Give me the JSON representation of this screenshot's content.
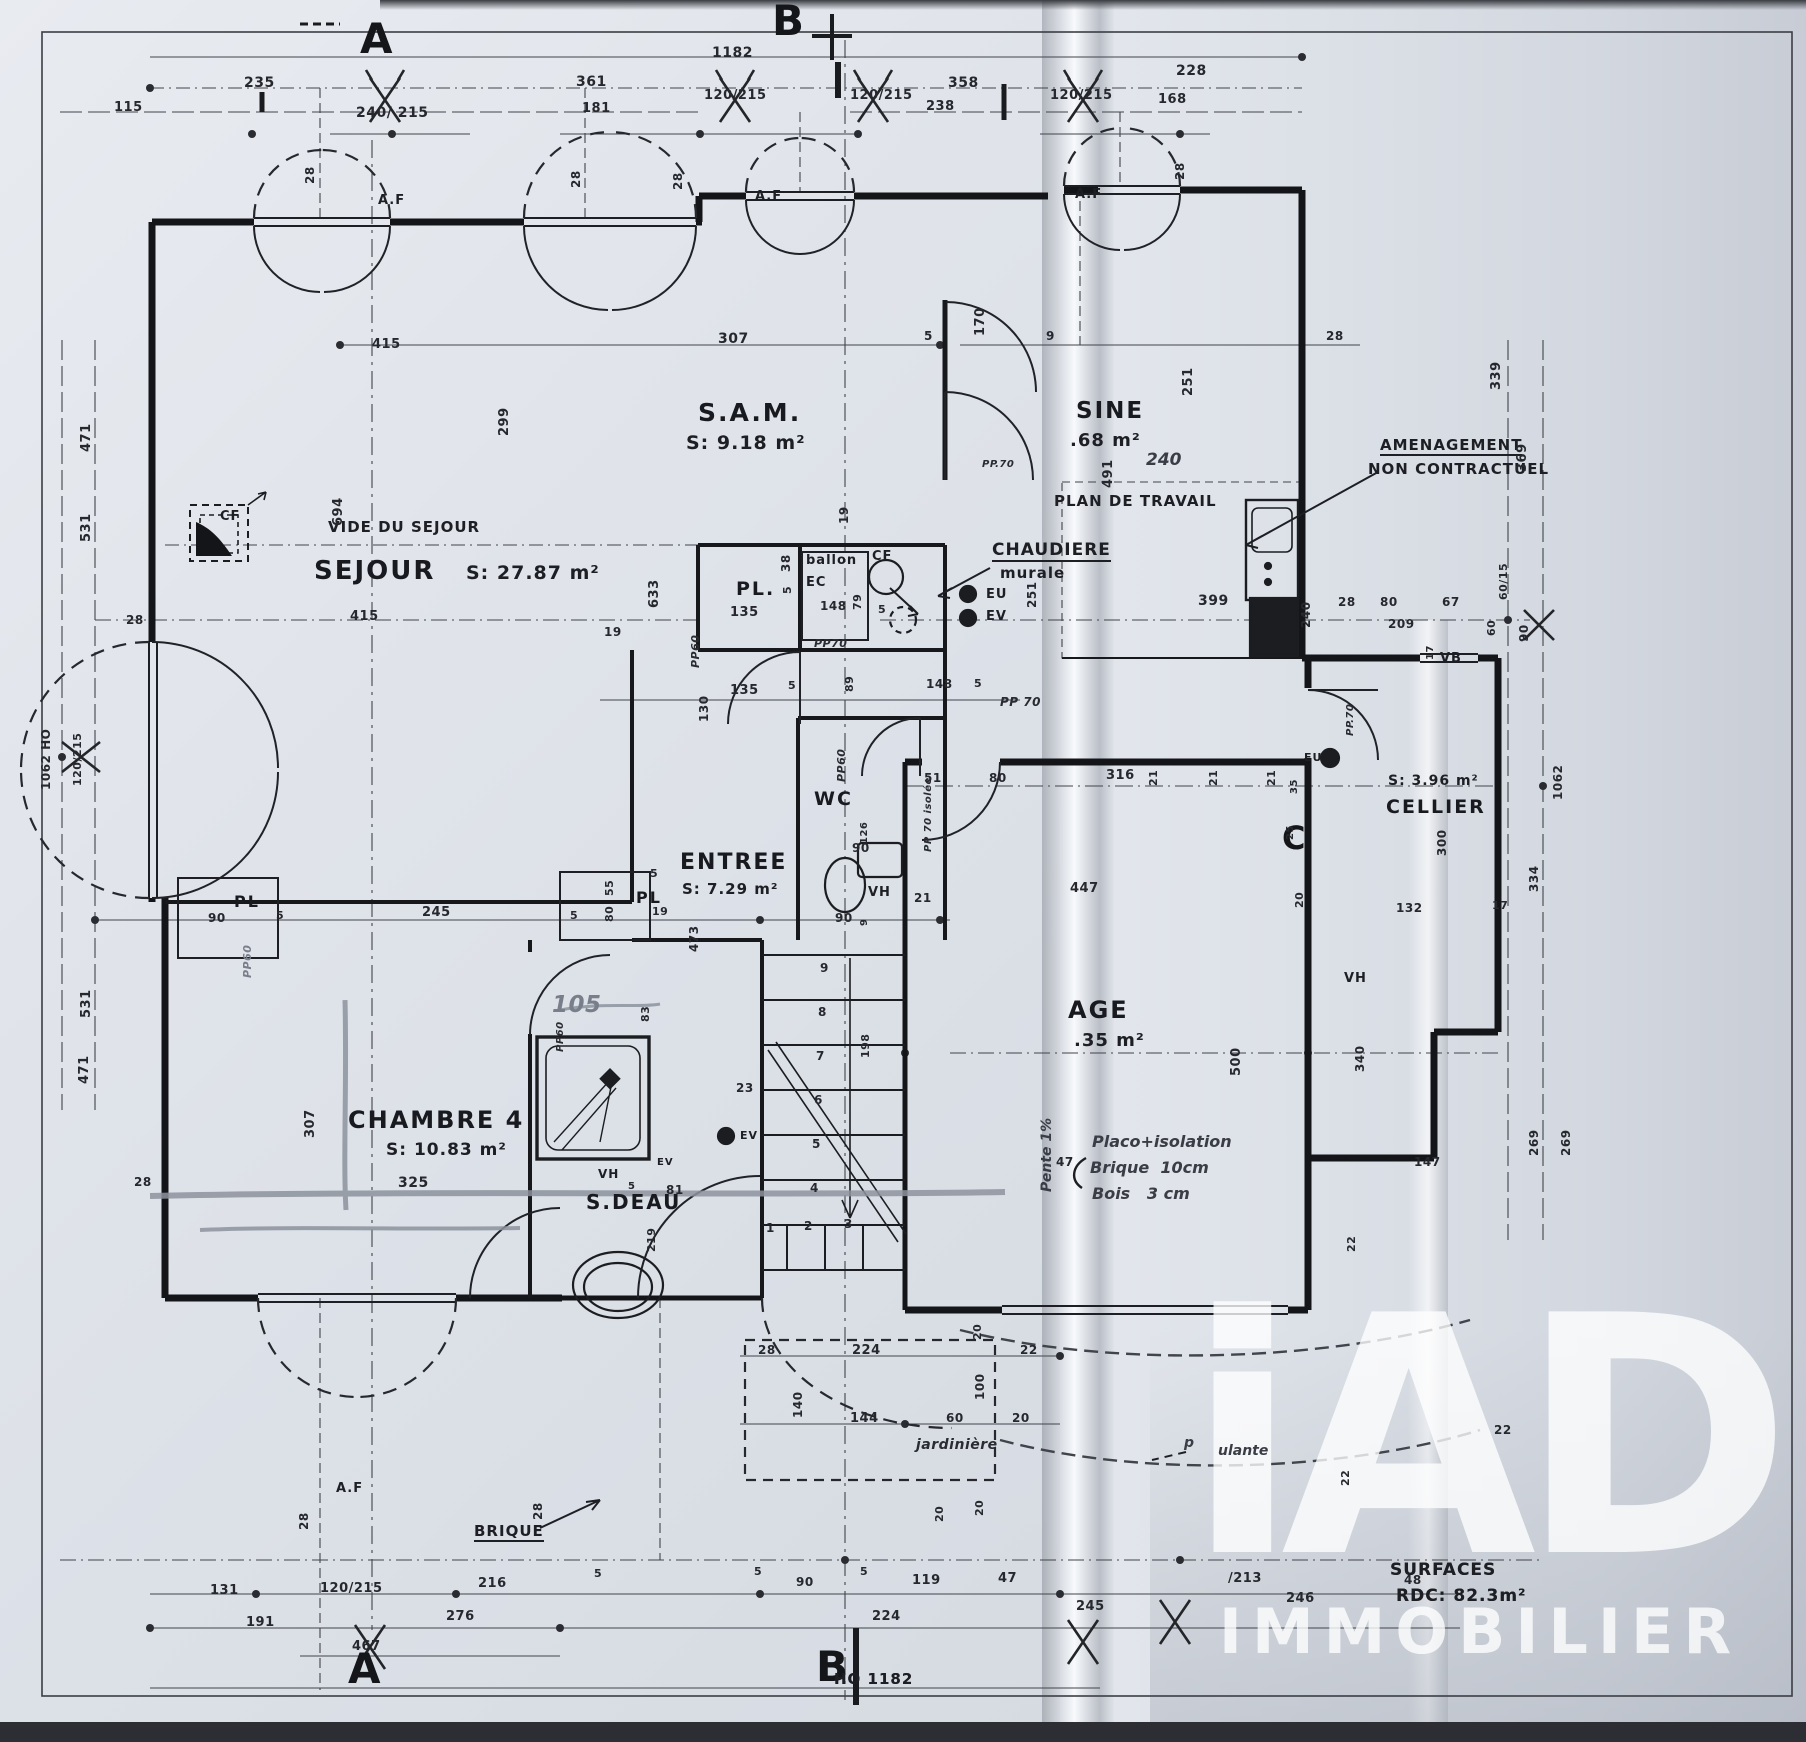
{
  "watermark": {
    "brand": "iAD",
    "subtitle": "IMMOBILIER"
  },
  "footer": {
    "surfaces_title": "SURFACES",
    "surfaces_value": "RDC: 82.3m²",
    "plan_ref": "HO 1182"
  },
  "section_markers": [
    {
      "t": "A",
      "x": 360,
      "y": 18,
      "s": 42
    },
    {
      "t": "B",
      "x": 772,
      "y": 0,
      "s": 42
    },
    {
      "t": "A",
      "x": 348,
      "y": 1648,
      "s": 42
    },
    {
      "t": "B",
      "x": 816,
      "y": 1646,
      "s": 42
    },
    {
      "t": "C",
      "x": 1282,
      "y": 822,
      "s": 32
    }
  ],
  "rooms": [
    {
      "t": "SEJOUR",
      "x": 314,
      "y": 558,
      "s": 26
    },
    {
      "t": "S: 27.87 m²",
      "x": 466,
      "y": 564,
      "s": 19,
      "k": "area"
    },
    {
      "t": "S.A.M.",
      "x": 698,
      "y": 400,
      "s": 25
    },
    {
      "t": "S: 9.18 m²",
      "x": 686,
      "y": 434,
      "s": 19,
      "k": "area"
    },
    {
      "t": "SINE",
      "x": 1076,
      "y": 400,
      "s": 23
    },
    {
      "t": ".68 m²",
      "x": 1070,
      "y": 432,
      "s": 18,
      "k": "area"
    },
    {
      "t": "ENTREE",
      "x": 680,
      "y": 852,
      "s": 22
    },
    {
      "t": "S: 7.29 m²",
      "x": 682,
      "y": 882,
      "s": 15,
      "k": "area"
    },
    {
      "t": "CHAMBRE 4",
      "x": 348,
      "y": 1108,
      "s": 24
    },
    {
      "t": "S: 10.83 m²",
      "x": 386,
      "y": 1142,
      "s": 17,
      "k": "area"
    },
    {
      "t": "S.DEAU",
      "x": 586,
      "y": 1192,
      "s": 20
    },
    {
      "t": "WC",
      "x": 814,
      "y": 790,
      "s": 19
    },
    {
      "t": "CELLIER",
      "x": 1386,
      "y": 798,
      "s": 19
    },
    {
      "t": "S: 3.96 m²",
      "x": 1388,
      "y": 774,
      "s": 14,
      "k": "area"
    },
    {
      "t": "AGE",
      "x": 1068,
      "y": 998,
      "s": 24
    },
    {
      "t": ".35 m²",
      "x": 1074,
      "y": 1032,
      "s": 18,
      "k": "area"
    },
    {
      "t": "PL.",
      "x": 736,
      "y": 580,
      "s": 19
    },
    {
      "t": "PL",
      "x": 234,
      "y": 894,
      "s": 16
    },
    {
      "t": "PL",
      "x": 636,
      "y": 890,
      "s": 16
    },
    {
      "t": "VIDE DU SEJOUR",
      "x": 328,
      "y": 520,
      "s": 15,
      "k": "ann"
    },
    {
      "t": "PLAN DE TRAVAIL",
      "x": 1054,
      "y": 494,
      "s": 15,
      "k": "ann"
    }
  ],
  "annotations": [
    {
      "t": "A.F",
      "x": 378,
      "y": 194,
      "s": 13
    },
    {
      "t": "A.F",
      "x": 755,
      "y": 190,
      "s": 13
    },
    {
      "t": "A.F",
      "x": 1075,
      "y": 188,
      "s": 13
    },
    {
      "t": "A.F",
      "x": 336,
      "y": 1482,
      "s": 13
    },
    {
      "t": "CF",
      "x": 220,
      "y": 510,
      "s": 13
    },
    {
      "t": "CF",
      "x": 872,
      "y": 550,
      "s": 13
    },
    {
      "t": "ballon",
      "x": 806,
      "y": 554,
      "s": 13
    },
    {
      "t": "EC",
      "x": 806,
      "y": 576,
      "s": 13
    },
    {
      "t": "CHAUDIERE",
      "x": 992,
      "y": 542,
      "s": 17,
      "u": true
    },
    {
      "t": "murale",
      "x": 1000,
      "y": 566,
      "s": 15
    },
    {
      "t": "EU",
      "x": 986,
      "y": 588,
      "s": 13
    },
    {
      "t": "EV",
      "x": 986,
      "y": 610,
      "s": 13
    },
    {
      "t": "AMENAGEMENT",
      "x": 1380,
      "y": 438,
      "s": 15,
      "u": true
    },
    {
      "t": "NON CONTRACTUEL",
      "x": 1368,
      "y": 462,
      "s": 15
    },
    {
      "t": "VB",
      "x": 1440,
      "y": 652,
      "s": 13
    },
    {
      "t": "EU",
      "x": 1304,
      "y": 752,
      "s": 11
    },
    {
      "t": "VH",
      "x": 868,
      "y": 886,
      "s": 13
    },
    {
      "t": "VH",
      "x": 1344,
      "y": 972,
      "s": 13
    },
    {
      "t": "VH",
      "x": 598,
      "y": 1168,
      "s": 12
    },
    {
      "t": "EV",
      "x": 740,
      "y": 1130,
      "s": 11
    },
    {
      "t": "EV",
      "x": 657,
      "y": 1158,
      "s": 10
    },
    {
      "t": "jardinière",
      "x": 916,
      "y": 1438,
      "s": 14,
      "k": "it"
    },
    {
      "t": "BRIQUE",
      "x": 474,
      "y": 1524,
      "s": 15,
      "u": true
    },
    {
      "t": "PP60",
      "x": 690,
      "y": 668,
      "s": 11,
      "r": 1,
      "k": "it"
    },
    {
      "t": "PP60",
      "x": 836,
      "y": 782,
      "s": 11,
      "r": 1,
      "k": "it"
    },
    {
      "t": "PP60",
      "x": 242,
      "y": 978,
      "s": 11,
      "r": 1,
      "k": "pencil"
    },
    {
      "t": "PP60",
      "x": 556,
      "y": 1052,
      "s": 10,
      "r": 1,
      "k": "it"
    },
    {
      "t": "PP.70",
      "x": 982,
      "y": 460,
      "s": 10,
      "k": "it"
    },
    {
      "t": "PP70",
      "x": 814,
      "y": 638,
      "s": 11,
      "k": "it"
    },
    {
      "t": "PP 70",
      "x": 1000,
      "y": 696,
      "s": 12,
      "k": "it"
    },
    {
      "t": "PP 70 isolée",
      "x": 924,
      "y": 852,
      "s": 10,
      "r": 1,
      "k": "it"
    },
    {
      "t": "PP.70",
      "x": 1346,
      "y": 736,
      "s": 10,
      "r": 1,
      "k": "it"
    },
    {
      "t": "SURFACES",
      "x": 1390,
      "y": 1562,
      "s": 17
    },
    {
      "t": "RDC: 82.3m²",
      "x": 1396,
      "y": 1588,
      "s": 17
    },
    {
      "t": "HO 1182",
      "x": 834,
      "y": 1672,
      "s": 15
    }
  ],
  "handwritten": [
    {
      "t": "240",
      "x": 1146,
      "y": 452,
      "s": 17
    },
    {
      "t": "105",
      "x": 552,
      "y": 994,
      "s": 23,
      "k": "pencil"
    },
    {
      "t": "Placo+isolation",
      "x": 1092,
      "y": 1134,
      "s": 16
    },
    {
      "t": "Brique  10cm",
      "x": 1090,
      "y": 1160,
      "s": 16
    },
    {
      "t": "Bois   3 cm",
      "x": 1092,
      "y": 1186,
      "s": 16
    },
    {
      "t": "Pente 1%",
      "x": 1040,
      "y": 1192,
      "s": 14,
      "r": 1
    },
    {
      "t": "p",
      "x": 1184,
      "y": 1436,
      "s": 14
    },
    {
      "t": "ulante",
      "x": 1218,
      "y": 1444,
      "s": 14
    }
  ],
  "dimensions": [
    {
      "t": "1182",
      "x": 712,
      "y": 46,
      "s": 14
    },
    {
      "t": "235",
      "x": 244,
      "y": 76,
      "s": 14
    },
    {
      "t": "115",
      "x": 114,
      "y": 101,
      "s": 13
    },
    {
      "t": "240/ 215",
      "x": 356,
      "y": 106,
      "s": 14
    },
    {
      "t": "361",
      "x": 576,
      "y": 75,
      "s": 14
    },
    {
      "t": "181",
      "x": 582,
      "y": 102,
      "s": 13
    },
    {
      "t": "120/215",
      "x": 704,
      "y": 89,
      "s": 13
    },
    {
      "t": "120/215",
      "x": 850,
      "y": 89,
      "s": 13
    },
    {
      "t": "358",
      "x": 948,
      "y": 76,
      "s": 14
    },
    {
      "t": "238",
      "x": 926,
      "y": 100,
      "s": 13
    },
    {
      "t": "120/215",
      "x": 1050,
      "y": 89,
      "s": 13
    },
    {
      "t": "228",
      "x": 1176,
      "y": 64,
      "s": 14
    },
    {
      "t": "168",
      "x": 1158,
      "y": 93,
      "s": 13
    },
    {
      "t": "28",
      "x": 304,
      "y": 184,
      "s": 12,
      "r": 1
    },
    {
      "t": "28",
      "x": 570,
      "y": 188,
      "s": 12,
      "r": 1
    },
    {
      "t": "28",
      "x": 672,
      "y": 190,
      "s": 12,
      "r": 1
    },
    {
      "t": "28",
      "x": 1174,
      "y": 180,
      "s": 12,
      "r": 1
    },
    {
      "t": "471",
      "x": 80,
      "y": 452,
      "s": 13,
      "r": 1
    },
    {
      "t": "531",
      "x": 80,
      "y": 542,
      "s": 13,
      "r": 1
    },
    {
      "t": "1062 HO",
      "x": 40,
      "y": 790,
      "s": 12,
      "r": 1
    },
    {
      "t": "120/215",
      "x": 72,
      "y": 786,
      "s": 11,
      "r": 1
    },
    {
      "t": "28",
      "x": 126,
      "y": 614,
      "s": 12
    },
    {
      "t": "531",
      "x": 80,
      "y": 1018,
      "s": 13,
      "r": 1
    },
    {
      "t": "471",
      "x": 78,
      "y": 1084,
      "s": 13,
      "r": 1
    },
    {
      "t": "28",
      "x": 134,
      "y": 1176,
      "s": 12
    },
    {
      "t": "415",
      "x": 372,
      "y": 338,
      "s": 13
    },
    {
      "t": "307",
      "x": 718,
      "y": 332,
      "s": 14
    },
    {
      "t": "5",
      "x": 924,
      "y": 330,
      "s": 12
    },
    {
      "t": "9",
      "x": 1046,
      "y": 330,
      "s": 12
    },
    {
      "t": "170",
      "x": 974,
      "y": 336,
      "s": 13,
      "r": 1
    },
    {
      "t": "299",
      "x": 498,
      "y": 436,
      "s": 13,
      "r": 1
    },
    {
      "t": "251",
      "x": 1182,
      "y": 396,
      "s": 13,
      "r": 1
    },
    {
      "t": "491",
      "x": 1102,
      "y": 488,
      "s": 13,
      "r": 1
    },
    {
      "t": "28",
      "x": 1326,
      "y": 330,
      "s": 12
    },
    {
      "t": "339",
      "x": 1490,
      "y": 390,
      "s": 13,
      "r": 1
    },
    {
      "t": "369",
      "x": 1516,
      "y": 472,
      "s": 13,
      "r": 1
    },
    {
      "t": "694",
      "x": 332,
      "y": 526,
      "s": 13,
      "r": 1
    },
    {
      "t": "415",
      "x": 350,
      "y": 610,
      "s": 13
    },
    {
      "t": "633",
      "x": 648,
      "y": 608,
      "s": 13,
      "r": 1
    },
    {
      "t": "19",
      "x": 838,
      "y": 524,
      "s": 12,
      "r": 1
    },
    {
      "t": "38",
      "x": 780,
      "y": 572,
      "s": 12,
      "r": 1
    },
    {
      "t": "5",
      "x": 782,
      "y": 594,
      "s": 11,
      "r": 1
    },
    {
      "t": "135",
      "x": 730,
      "y": 606,
      "s": 13
    },
    {
      "t": "148",
      "x": 820,
      "y": 600,
      "s": 12
    },
    {
      "t": "79",
      "x": 852,
      "y": 610,
      "s": 11,
      "r": 1
    },
    {
      "t": "5",
      "x": 878,
      "y": 604,
      "s": 11
    },
    {
      "t": "399",
      "x": 1198,
      "y": 594,
      "s": 14
    },
    {
      "t": "251",
      "x": 1026,
      "y": 608,
      "s": 12,
      "r": 1
    },
    {
      "t": "28",
      "x": 1338,
      "y": 596,
      "s": 12
    },
    {
      "t": "80",
      "x": 1380,
      "y": 596,
      "s": 12
    },
    {
      "t": "67",
      "x": 1442,
      "y": 596,
      "s": 12
    },
    {
      "t": "209",
      "x": 1388,
      "y": 618,
      "s": 12
    },
    {
      "t": "240",
      "x": 1300,
      "y": 628,
      "s": 12,
      "r": 1
    },
    {
      "t": "60/15",
      "x": 1498,
      "y": 600,
      "s": 11,
      "r": 1
    },
    {
      "t": "60",
      "x": 1486,
      "y": 636,
      "s": 11,
      "r": 1
    },
    {
      "t": "90",
      "x": 1518,
      "y": 642,
      "s": 12,
      "r": 1
    },
    {
      "t": "17",
      "x": 1426,
      "y": 660,
      "s": 10,
      "r": 1
    },
    {
      "t": "19",
      "x": 604,
      "y": 626,
      "s": 12
    },
    {
      "t": "135",
      "x": 730,
      "y": 684,
      "s": 13
    },
    {
      "t": "5",
      "x": 788,
      "y": 680,
      "s": 11
    },
    {
      "t": "89",
      "x": 844,
      "y": 692,
      "s": 11,
      "r": 1
    },
    {
      "t": "148",
      "x": 926,
      "y": 678,
      "s": 12
    },
    {
      "t": "5",
      "x": 974,
      "y": 678,
      "s": 11
    },
    {
      "t": "130",
      "x": 698,
      "y": 722,
      "s": 12,
      "r": 1
    },
    {
      "t": "51",
      "x": 924,
      "y": 772,
      "s": 12
    },
    {
      "t": "80",
      "x": 989,
      "y": 772,
      "s": 12
    },
    {
      "t": "316",
      "x": 1106,
      "y": 769,
      "s": 13
    },
    {
      "t": "21",
      "x": 1148,
      "y": 786,
      "s": 11,
      "r": 1
    },
    {
      "t": "21",
      "x": 1208,
      "y": 786,
      "s": 11,
      "r": 1
    },
    {
      "t": "21",
      "x": 1266,
      "y": 786,
      "s": 11,
      "r": 1
    },
    {
      "t": "35",
      "x": 1290,
      "y": 794,
      "s": 10,
      "r": 1
    },
    {
      "t": "25",
      "x": 1286,
      "y": 840,
      "s": 10,
      "r": 1
    },
    {
      "t": "126",
      "x": 860,
      "y": 844,
      "s": 10,
      "r": 1
    },
    {
      "t": "90",
      "x": 852,
      "y": 842,
      "s": 12
    },
    {
      "t": "21",
      "x": 914,
      "y": 892,
      "s": 12
    },
    {
      "t": "90",
      "x": 835,
      "y": 912,
      "s": 12
    },
    {
      "t": "9",
      "x": 860,
      "y": 926,
      "s": 10,
      "r": 1
    },
    {
      "t": "447",
      "x": 1070,
      "y": 882,
      "s": 13
    },
    {
      "t": "473",
      "x": 688,
      "y": 952,
      "s": 12,
      "r": 1
    },
    {
      "t": "500",
      "x": 1230,
      "y": 1076,
      "s": 13,
      "r": 1
    },
    {
      "t": "340",
      "x": 1354,
      "y": 1072,
      "s": 12,
      "r": 1
    },
    {
      "t": "132",
      "x": 1396,
      "y": 902,
      "s": 12
    },
    {
      "t": "17",
      "x": 1492,
      "y": 900,
      "s": 11
    },
    {
      "t": "20",
      "x": 1294,
      "y": 908,
      "s": 11,
      "r": 1
    },
    {
      "t": "300",
      "x": 1436,
      "y": 856,
      "s": 12,
      "r": 1
    },
    {
      "t": "334",
      "x": 1528,
      "y": 892,
      "s": 12,
      "r": 1
    },
    {
      "t": "1062",
      "x": 1552,
      "y": 800,
      "s": 12,
      "r": 1
    },
    {
      "t": "147",
      "x": 1414,
      "y": 1156,
      "s": 12
    },
    {
      "t": "269",
      "x": 1528,
      "y": 1156,
      "s": 12,
      "r": 1
    },
    {
      "t": "269",
      "x": 1560,
      "y": 1156,
      "s": 12,
      "r": 1
    },
    {
      "t": "22",
      "x": 1346,
      "y": 1252,
      "s": 11,
      "r": 1
    },
    {
      "t": "90",
      "x": 208,
      "y": 912,
      "s": 12
    },
    {
      "t": "5",
      "x": 276,
      "y": 910,
      "s": 11
    },
    {
      "t": "245",
      "x": 422,
      "y": 906,
      "s": 13
    },
    {
      "t": "5",
      "x": 570,
      "y": 910,
      "s": 11
    },
    {
      "t": "80",
      "x": 604,
      "y": 922,
      "s": 11,
      "r": 1
    },
    {
      "t": "55",
      "x": 604,
      "y": 896,
      "s": 11,
      "r": 1
    },
    {
      "t": "5",
      "x": 650,
      "y": 868,
      "s": 11
    },
    {
      "t": "19",
      "x": 652,
      "y": 906,
      "s": 11
    },
    {
      "t": "307",
      "x": 304,
      "y": 1138,
      "s": 13,
      "r": 1
    },
    {
      "t": "325",
      "x": 398,
      "y": 1176,
      "s": 14
    },
    {
      "t": "83",
      "x": 640,
      "y": 1022,
      "s": 11,
      "r": 1
    },
    {
      "t": "23",
      "x": 736,
      "y": 1082,
      "s": 12
    },
    {
      "t": "81",
      "x": 666,
      "y": 1184,
      "s": 12
    },
    {
      "t": "5",
      "x": 628,
      "y": 1182,
      "s": 10
    },
    {
      "t": "219",
      "x": 646,
      "y": 1252,
      "s": 11,
      "r": 1
    },
    {
      "t": "198",
      "x": 860,
      "y": 1058,
      "s": 11,
      "r": 1
    },
    {
      "t": "9",
      "x": 820,
      "y": 962,
      "s": 12
    },
    {
      "t": "8",
      "x": 818,
      "y": 1006,
      "s": 12
    },
    {
      "t": "7",
      "x": 816,
      "y": 1050,
      "s": 12
    },
    {
      "t": "6",
      "x": 814,
      "y": 1094,
      "s": 12
    },
    {
      "t": "5",
      "x": 812,
      "y": 1138,
      "s": 12
    },
    {
      "t": "4",
      "x": 810,
      "y": 1182,
      "s": 12
    },
    {
      "t": "1",
      "x": 766,
      "y": 1222,
      "s": 12
    },
    {
      "t": "2",
      "x": 804,
      "y": 1220,
      "s": 12
    },
    {
      "t": "3",
      "x": 844,
      "y": 1218,
      "s": 12
    },
    {
      "t": "28",
      "x": 758,
      "y": 1344,
      "s": 12
    },
    {
      "t": "224",
      "x": 852,
      "y": 1344,
      "s": 13
    },
    {
      "t": "22",
      "x": 1020,
      "y": 1344,
      "s": 12
    },
    {
      "t": "140",
      "x": 792,
      "y": 1418,
      "s": 12,
      "r": 1
    },
    {
      "t": "144",
      "x": 850,
      "y": 1412,
      "s": 13
    },
    {
      "t": "60",
      "x": 946,
      "y": 1412,
      "s": 12
    },
    {
      "t": "100",
      "x": 974,
      "y": 1400,
      "s": 12,
      "r": 1
    },
    {
      "t": "20",
      "x": 1012,
      "y": 1412,
      "s": 12
    },
    {
      "t": "20",
      "x": 972,
      "y": 1340,
      "s": 11,
      "r": 1
    },
    {
      "t": "20",
      "x": 974,
      "y": 1516,
      "s": 11,
      "r": 1
    },
    {
      "t": "47",
      "x": 1056,
      "y": 1156,
      "s": 12
    },
    {
      "t": "22",
      "x": 1494,
      "y": 1424,
      "s": 12
    },
    {
      "t": "22",
      "x": 1340,
      "y": 1486,
      "s": 11,
      "r": 1
    },
    {
      "t": "48",
      "x": 1404,
      "y": 1574,
      "s": 12
    },
    {
      "t": "246",
      "x": 1286,
      "y": 1592,
      "s": 13
    },
    {
      "t": "/213",
      "x": 1228,
      "y": 1572,
      "s": 13
    },
    {
      "t": "28",
      "x": 298,
      "y": 1530,
      "s": 12,
      "r": 1
    },
    {
      "t": "28",
      "x": 532,
      "y": 1520,
      "s": 12,
      "r": 1
    },
    {
      "t": "20",
      "x": 934,
      "y": 1522,
      "s": 11,
      "r": 1
    },
    {
      "t": "131",
      "x": 210,
      "y": 1584,
      "s": 13
    },
    {
      "t": "120/215",
      "x": 320,
      "y": 1582,
      "s": 13
    },
    {
      "t": "216",
      "x": 478,
      "y": 1577,
      "s": 13
    },
    {
      "t": "191",
      "x": 246,
      "y": 1616,
      "s": 13
    },
    {
      "t": "276",
      "x": 446,
      "y": 1610,
      "s": 13
    },
    {
      "t": "467",
      "x": 352,
      "y": 1640,
      "s": 13
    },
    {
      "t": "5",
      "x": 594,
      "y": 1568,
      "s": 11
    },
    {
      "t": "5",
      "x": 754,
      "y": 1566,
      "s": 11
    },
    {
      "t": "90",
      "x": 796,
      "y": 1576,
      "s": 12
    },
    {
      "t": "5",
      "x": 860,
      "y": 1566,
      "s": 11
    },
    {
      "t": "119",
      "x": 912,
      "y": 1574,
      "s": 13
    },
    {
      "t": "47",
      "x": 998,
      "y": 1572,
      "s": 13
    },
    {
      "t": "224",
      "x": 872,
      "y": 1610,
      "s": 13
    },
    {
      "t": "245",
      "x": 1076,
      "y": 1600,
      "s": 13
    }
  ]
}
